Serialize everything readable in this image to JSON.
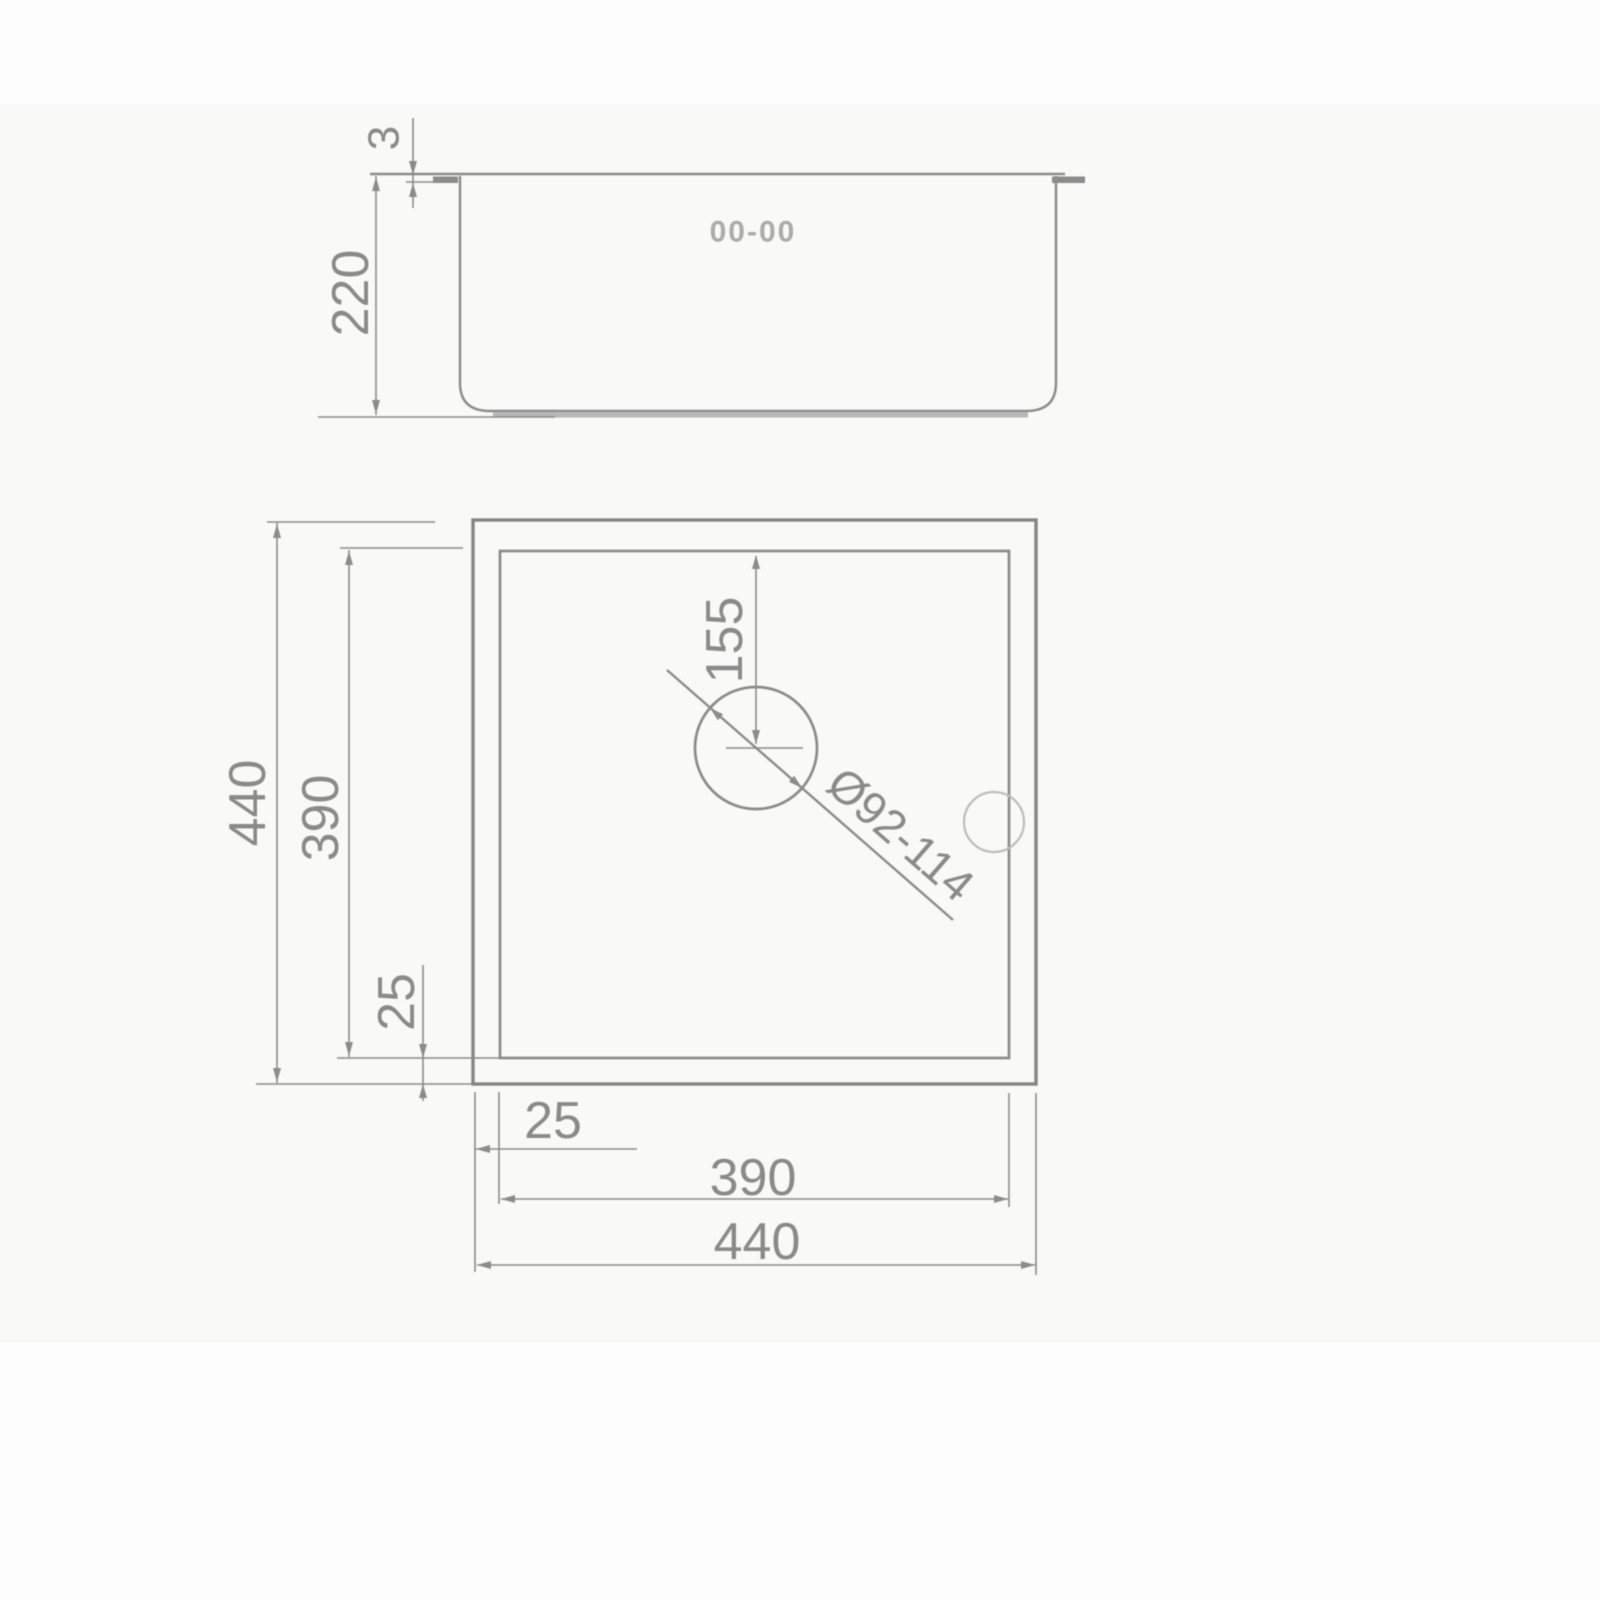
{
  "diagram": {
    "type": "technical-drawing",
    "subject": "sink dimension drawing, side elevation and plan view",
    "side_view": {
      "logo": "00-00",
      "rim_thickness": "3",
      "depth": "220"
    },
    "plan_view": {
      "left_overall": "440",
      "left_inner": "390",
      "left_offset": "25",
      "bottom_offset": "25",
      "bottom_inner": "390",
      "bottom_overall": "440",
      "drain_offset": "155",
      "drain_diameter": "Ø92-114"
    },
    "colors": {
      "line": "#8b8b8b",
      "outline_dark": "#858585",
      "text": "#8a8a8a",
      "faint_circle": "#bdbdbd",
      "shadow": "#a6a6a6",
      "background": "#f9f9f8"
    }
  }
}
